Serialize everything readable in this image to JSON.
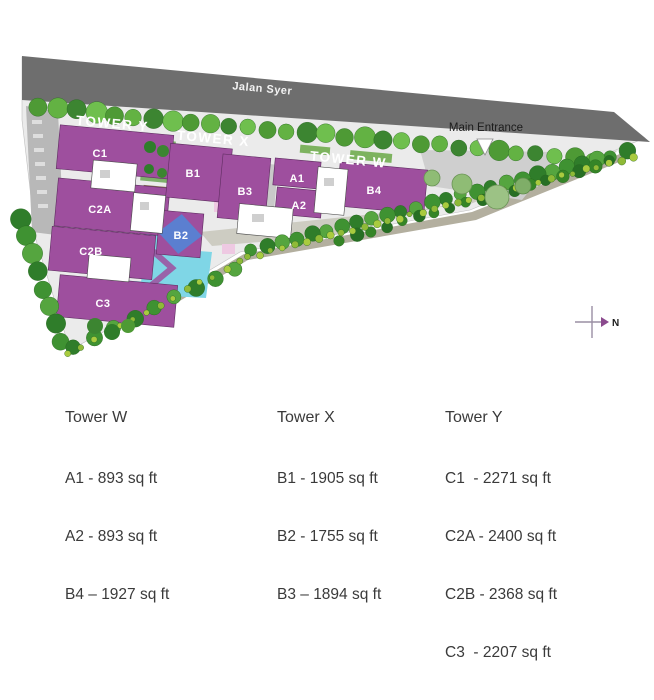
{
  "map": {
    "road_label": "Jalan Syer",
    "entrance_label": "Main Entrance",
    "north_label": "N",
    "towers": {
      "y": "TOWER Y",
      "x": "TOWER X",
      "w": "TOWER W"
    },
    "units": {
      "c1": "C1",
      "c2a": "C2A",
      "c2b": "C2B",
      "c3": "C3",
      "b1": "B1",
      "b2": "B2",
      "b3": "B3",
      "b4": "B4",
      "a1": "A1",
      "a2": "A2"
    },
    "colors": {
      "building_purple": "#9e4f9e",
      "road_gray": "#6e6e6e",
      "pool_cyan": "#7fd6e6",
      "b2_blue": "#5b7fd0",
      "site_paving": "#ebebeb",
      "tree_green": "#4e9a35",
      "legend_text": "#3a3a3a"
    }
  },
  "legend": {
    "columns": [
      {
        "title": "Tower W",
        "items": [
          "A1 - 893 sq ft",
          "A2 - 893 sq ft",
          "B4 – 1927 sq ft"
        ]
      },
      {
        "title": "Tower X",
        "items": [
          "B1 - 1905 sq ft",
          "B2 - 1755 sq ft",
          "B3 – 1894 sq ft"
        ]
      },
      {
        "title": "Tower Y",
        "items": [
          "C1  - 2271 sq ft",
          "C2A - 2400 sq ft",
          "C2B - 2368 sq ft",
          "C3  - 2207 sq ft"
        ]
      }
    ]
  }
}
